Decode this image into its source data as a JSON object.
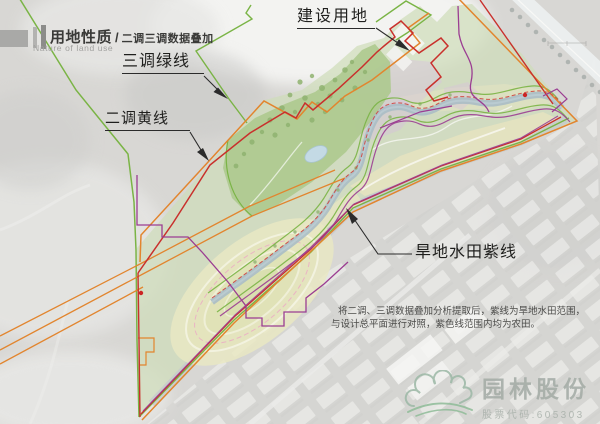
{
  "header": {
    "title": "用地性质",
    "slash": "/",
    "subtitle": "二调三调数据叠加",
    "title_en": "Nature of land use"
  },
  "callouts": {
    "green": "三调绿线",
    "yellow": "二调黄线",
    "construction": "建设用地",
    "purple": "旱地水田紫线"
  },
  "note": {
    "line1": "将二调、三调数据叠加分析提取后，紫线为旱地水田范围，",
    "line2": "与设计总平面进行对照，紫色线范围内均为农田。"
  },
  "watermark": {
    "company": "园林股份",
    "stock_label": "股票代码:605303"
  },
  "map": {
    "line_colors": {
      "survey3_green": "#7ab445",
      "survey2_orange": "#e2852e",
      "red_boundary": "#c9302c",
      "dryland_paddy_purple": "#9b3d92"
    }
  }
}
